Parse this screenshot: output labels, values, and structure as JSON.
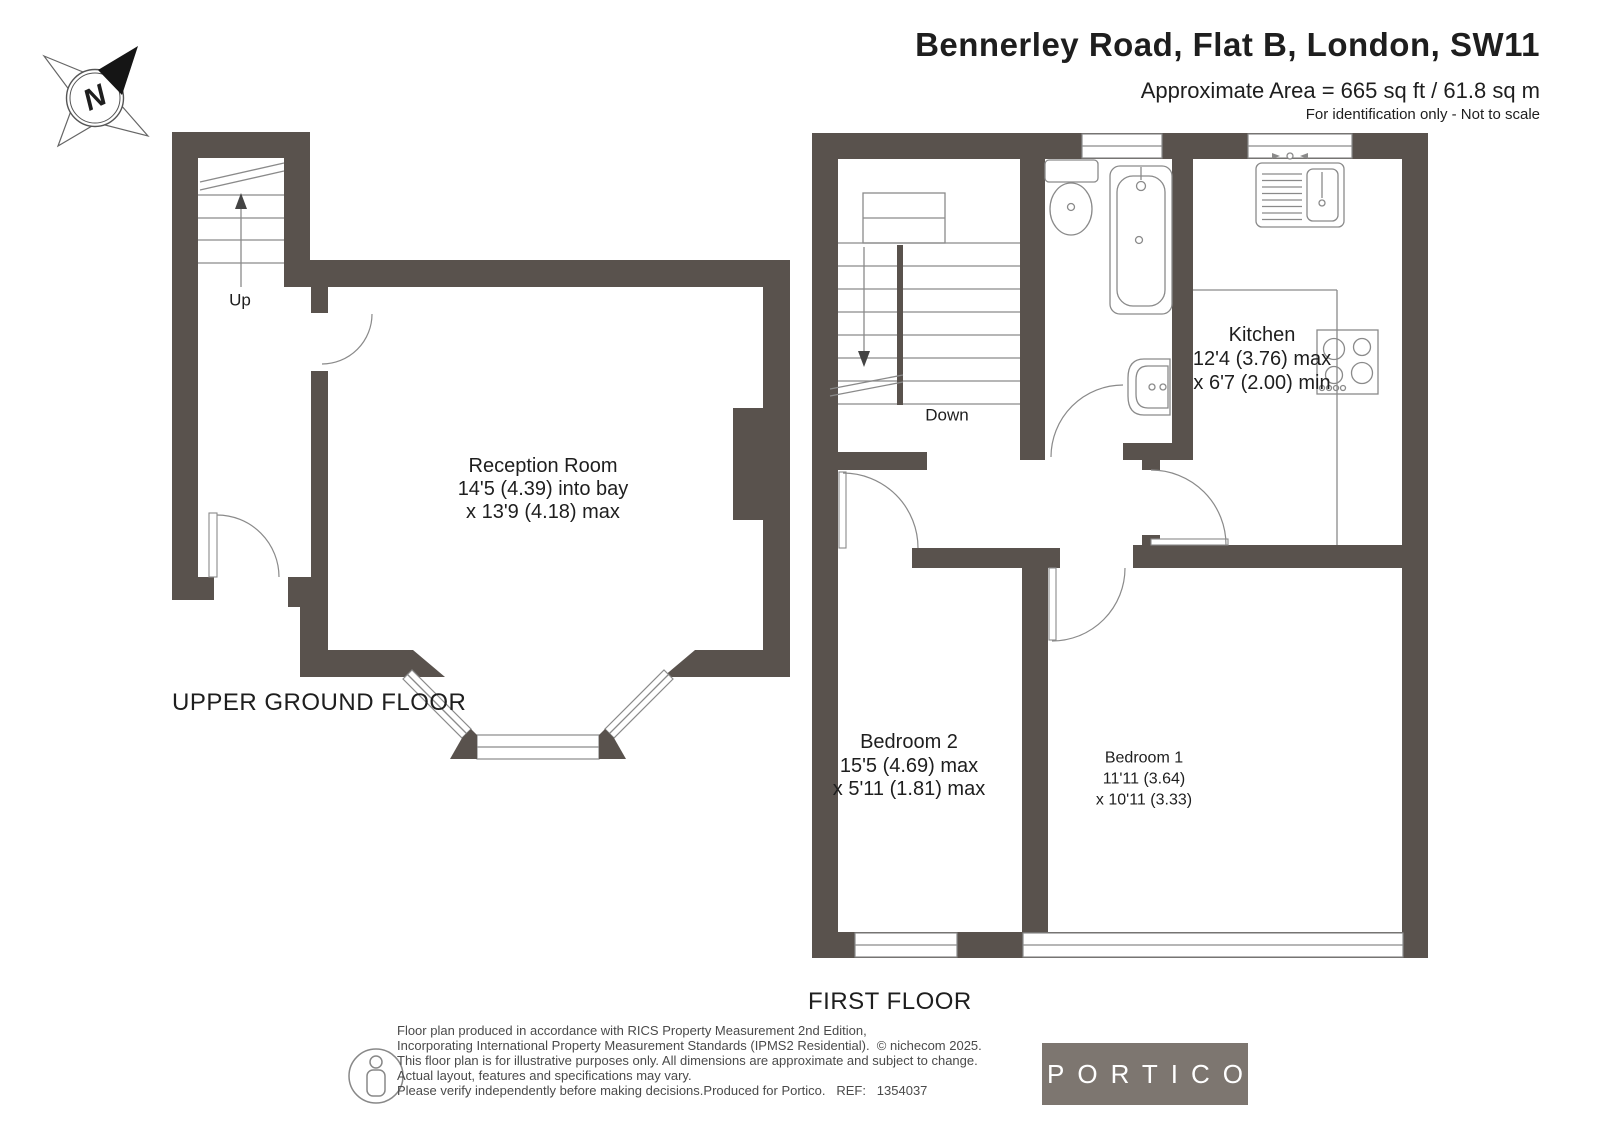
{
  "header": {
    "title": "Bennerley Road, Flat B, London, SW11",
    "area": "Approximate Area = 665 sq ft / 61.8 sq m",
    "note": "For identification only - Not to scale"
  },
  "compass": {
    "label": "N"
  },
  "plans": {
    "upper_ground": {
      "floor_label": "UPPER GROUND FLOOR",
      "stairs_label": "Up",
      "reception": {
        "name": "Reception Room",
        "dim1": "14'5 (4.39) into bay",
        "dim2": "x 13'9 (4.18) max"
      }
    },
    "first": {
      "floor_label": "FIRST FLOOR",
      "stairs_label": "Down",
      "kitchen": {
        "name": "Kitchen",
        "dim1": "12'4 (3.76) max",
        "dim2": "x 6'7 (2.00) min"
      },
      "bedroom2": {
        "name": "Bedroom 2",
        "dim1": "15'5 (4.69) max",
        "dim2": "x 5'11 (1.81) max"
      },
      "bedroom1": {
        "name": "Bedroom 1",
        "dim1": "11'11 (3.64)",
        "dim2": "x 10'11 (3.33)"
      }
    }
  },
  "footer": {
    "disclaimer": [
      "Floor plan produced in accordance with RICS Property Measurement 2nd Edition,",
      "Incorporating International Property Measurement Standards (IPMS2 Residential).  © nichecom 2025.",
      "This floor plan is for illustrative purposes only. All dimensions are approximate and subject to change.",
      "Actual layout, features and specifications may vary.",
      "Please verify independently before making decisions.Produced for Portico.   REF:   1354037"
    ],
    "logo": "PORTICO"
  },
  "colors": {
    "wall": "#59524d",
    "line": "#8a8a8a",
    "text": "#1e1e1e",
    "muted": "#4a4a4a",
    "logo_bg": "#7d7670"
  }
}
